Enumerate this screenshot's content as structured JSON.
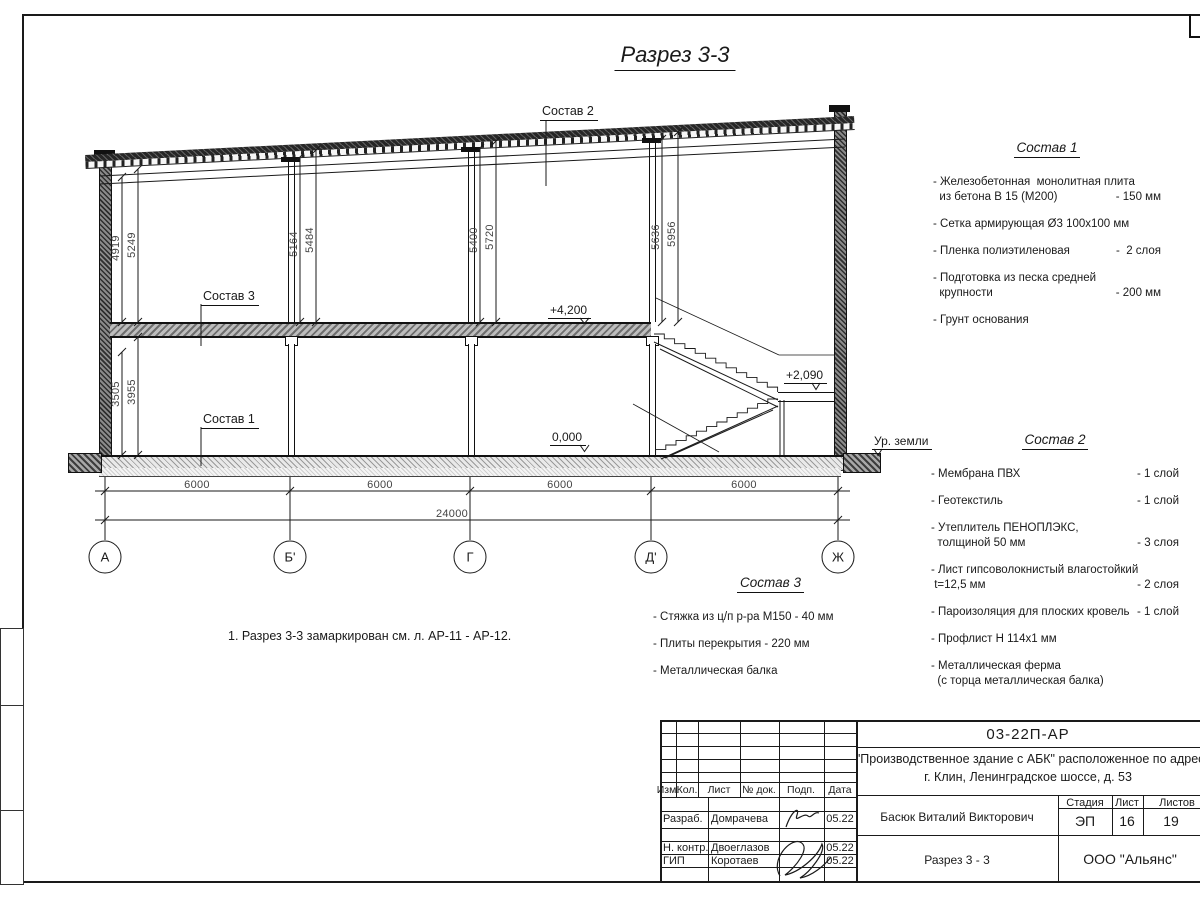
{
  "page": {
    "title": "Разрез 3-3"
  },
  "note": "1. Разрез 3-3 замаркирован см. л. АР-11 - АР-12.",
  "drawing": {
    "callouts": {
      "roof": "Состав 2",
      "mid": "Состав 3",
      "floor": "Состав 1"
    },
    "levels": {
      "mid": "+4,200",
      "ground": "0,000",
      "landing": "+2,090",
      "terrain": "Ур. земли"
    },
    "axes": [
      "А",
      "Б'",
      "Г",
      "Д'",
      "Ж"
    ],
    "hdims": [
      "6000",
      "6000",
      "6000",
      "6000"
    ],
    "total": "24000",
    "vdims": [
      "4919",
      "5249",
      "5164",
      "5484",
      "5400",
      "5720",
      "5636",
      "5956",
      "3505",
      "3955"
    ]
  },
  "spec1": {
    "title": "Состав 1",
    "items": [
      [
        [
          "- Железобетонная  монолитная плита"
        ],
        [
          "  из бетона В 15 (М200)",
          "- 150 мм"
        ]
      ],
      [
        [
          "- Сетка армирующая Ø3 100x100 мм"
        ]
      ],
      [
        [
          "- Пленка полиэтиленовая",
          "-  2 слоя"
        ]
      ],
      [
        [
          "- Подготовка из песка средней"
        ],
        [
          "  крупности",
          "- 200 мм"
        ]
      ],
      [
        [
          "- Грунт основания"
        ]
      ]
    ]
  },
  "spec2": {
    "title": "Состав 2",
    "items": [
      [
        [
          "- Мембрана ПВХ",
          "- 1 слой"
        ]
      ],
      [
        [
          "- Геотекстиль",
          "- 1 слой"
        ]
      ],
      [
        [
          "- Утеплитель ПЕНОПЛЭКС,"
        ],
        [
          "  толщиной 50 мм",
          "- 3 слоя"
        ]
      ],
      [
        [
          "- Лист гипсоволокнистый влагостойкий"
        ],
        [
          " t=12,5 мм",
          "- 2 слоя"
        ]
      ],
      [
        [
          "- Пароизоляция для плоских кровель",
          "- 1 слой"
        ]
      ],
      [
        [
          "- Профлист Н 114x1 мм"
        ]
      ],
      [
        [
          "- Металлическая ферма"
        ],
        [
          "  (с торца металлическая балка)"
        ]
      ]
    ]
  },
  "spec3": {
    "title": "Состав 3",
    "items": [
      [
        [
          "- Стяжка из ц/п р-ра М150 - 40 мм"
        ]
      ],
      [
        [
          "- Плиты перекрытия - 220 мм"
        ]
      ],
      [
        [
          "- Металлическая балка"
        ]
      ]
    ]
  },
  "titleblock": {
    "doc_number": "03-22П-АР",
    "project_line1": "\"Производственное здание с АБК\" расположенное по адресу:",
    "project_line2": "г. Клин, Ленинградское шоссе, д. 53",
    "header_cols": [
      "Изм.",
      "Кол.",
      "Лист",
      "№ док.",
      "Подп.",
      "Дата"
    ],
    "rows": [
      {
        "role": "Разраб.",
        "name": "Домрачева",
        "date": "05.22"
      },
      {
        "role": "Н. контр.",
        "name": "Двоеглазов",
        "date": "05.22"
      },
      {
        "role": "ГИП",
        "name": "Коротаев",
        "date": "05.22"
      }
    ],
    "chief": "Басюк Виталий Викторович",
    "sheet_title": "Разрез 3 - 3",
    "stage_label": "Стадия",
    "sheet_label": "Лист",
    "sheets_label": "Листов",
    "stage": "ЭП",
    "sheet_no": "16",
    "sheets_total": "19",
    "company": "ООО \"Альянс\""
  }
}
